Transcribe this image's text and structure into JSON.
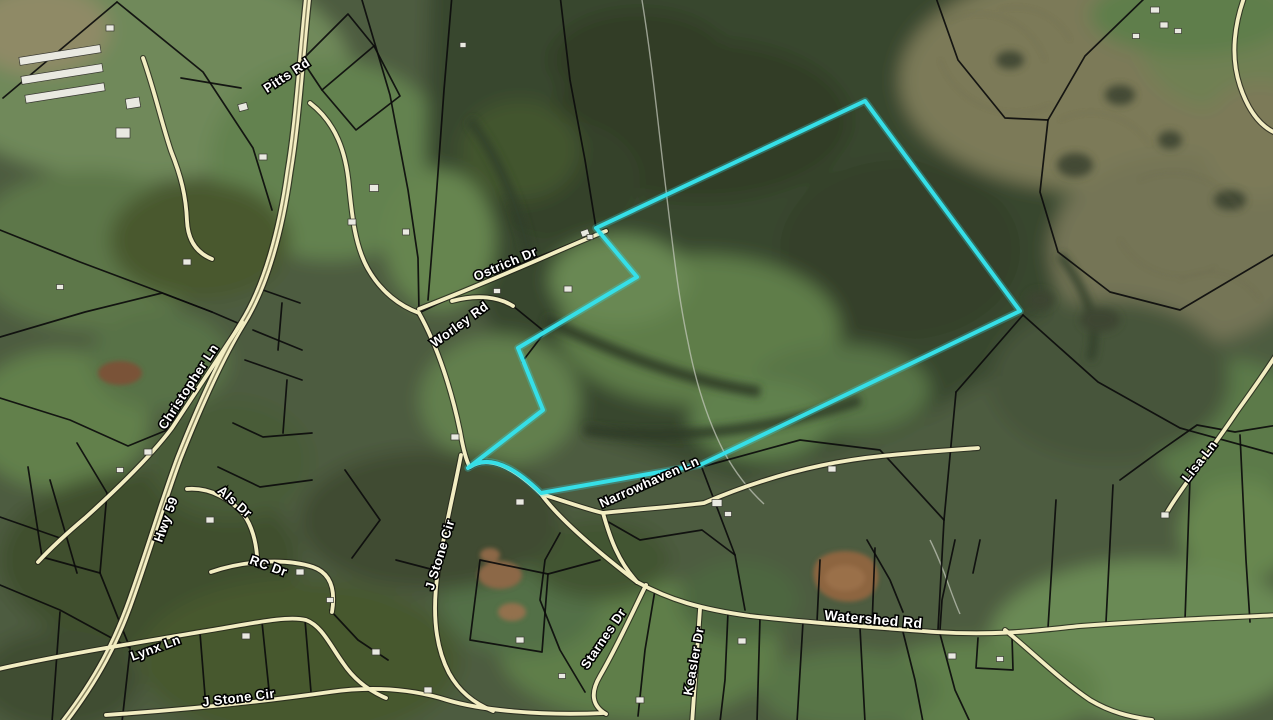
{
  "map": {
    "colors": {
      "highlight": "#36dfe8",
      "road_fill": "#f2edc2",
      "road_casing": "#23231a",
      "parcel_line": "#0c0c0c",
      "label_fill": "#ffffff",
      "label_outline": "#000000"
    },
    "highlight_parcel": {
      "path": "M596,228 L865,101 L1020,311 L700,465 L541,493 Q495,448 468,468 L543,410 L518,348 L637,277 Z"
    },
    "road_labels": [
      {
        "text": "Pitts Rd",
        "x": 289,
        "y": 79,
        "rot": -33,
        "size": 13
      },
      {
        "text": "Christopher Ln",
        "x": 192,
        "y": 389,
        "rot": -57,
        "size": 13
      },
      {
        "text": "Hwy 59",
        "x": 170,
        "y": 521,
        "rot": -70,
        "size": 13
      },
      {
        "text": "Als Dr",
        "x": 232,
        "y": 505,
        "rot": 41,
        "size": 13
      },
      {
        "text": "RC Dr",
        "x": 267,
        "y": 570,
        "rot": 20,
        "size": 13
      },
      {
        "text": "Lynx Ln",
        "x": 157,
        "y": 652,
        "rot": -20,
        "size": 13
      },
      {
        "text": "J Stone Cir",
        "x": 239,
        "y": 702,
        "rot": -7,
        "size": 13
      },
      {
        "text": "J Stone Cir",
        "x": 444,
        "y": 556,
        "rot": -73,
        "size": 13
      },
      {
        "text": "Ostrich Dr",
        "x": 507,
        "y": 268,
        "rot": -23,
        "size": 13
      },
      {
        "text": "Worley Rd",
        "x": 462,
        "y": 328,
        "rot": -36,
        "size": 13
      },
      {
        "text": "Starnes Dr",
        "x": 607,
        "y": 641,
        "rot": -56,
        "size": 13
      },
      {
        "text": "Keasler Dr",
        "x": 698,
        "y": 662,
        "rot": -80,
        "size": 13
      },
      {
        "text": "Narrowhaven Ln",
        "x": 651,
        "y": 486,
        "rot": -24,
        "size": 13
      },
      {
        "text": "Watershed Rd",
        "x": 873,
        "y": 624,
        "rot": 5,
        "size": 14
      },
      {
        "text": "Lisa Ln",
        "x": 1203,
        "y": 464,
        "rot": -52,
        "size": 13
      }
    ],
    "roads": [
      {
        "id": "pitts-hwy59",
        "name": "Pitts Rd / Hwy 59",
        "major": true,
        "path": "M308,-6 C301,58 298,118 289,172 C281,230 266,286 242,324 C220,360 198,410 179,458 C164,498 151,543 133,594 C117,641 97,679 64,722"
      },
      {
        "id": "christopher-ln",
        "name": "Christopher Ln",
        "major": false,
        "path": "M242,322 C222,352 203,381 172,428 C151,456 116,490 85,518 C66,534 50,549 38,562"
      },
      {
        "id": "als-dr",
        "name": "Als Dr",
        "major": false,
        "path": "M187,489 C210,487 232,500 244,515 C252,526 256,542 257,556"
      },
      {
        "id": "rc-dr",
        "name": "RC Dr",
        "major": false,
        "path": "M211,572 C240,562 282,557 313,567 C330,573 336,588 332,612"
      },
      {
        "id": "lynx-ln",
        "name": "Lynx Ln",
        "major": false,
        "path": "M-6,670 C60,655 130,644 200,632 C250,624 287,615 306,620 C322,626 330,645 343,663 C353,678 367,690 386,698"
      },
      {
        "id": "jstone-cir-s",
        "name": "J Stone Cir",
        "major": false,
        "path": "M106,715 C180,710 260,702 330,692 C372,686 412,689 447,700 C480,710 540,716 604,713"
      },
      {
        "id": "fork-n",
        "name": "",
        "major": false,
        "path": "M310,103 C336,123 346,152 349,186 C352,216 355,246 368,269 C381,292 400,306 419,313"
      },
      {
        "id": "fork-s",
        "name": "",
        "major": false,
        "path": "M419,313 C438,347 452,392 460,431 C463,448 466,461 470,467"
      },
      {
        "id": "jstone-cir-v",
        "name": "J Stone Cir",
        "major": false,
        "path": "M461,455 C454,492 444,532 438,571 C432,611 435,646 449,673 C459,691 473,703 493,711"
      },
      {
        "id": "ostrich-dr",
        "name": "Ostrich Dr",
        "major": false,
        "path": "M419,309 C460,293 510,272 556,252 C577,243 593,236 606,231"
      },
      {
        "id": "worley-rd",
        "name": "Worley Rd",
        "major": false,
        "path": "M452,301 C478,294 499,297 513,306"
      },
      {
        "id": "narrowhaven-w",
        "name": "Narrowhaven Ln",
        "major": false,
        "path": "M470,467 Q496,450 541,494 C562,500 582,508 603,513"
      },
      {
        "id": "narrowhaven-ne",
        "name": "Narrowhaven Ln",
        "major": false,
        "path": "M603,513 C640,509 672,507 704,503 C762,478 822,462 882,456 C920,452 950,450 978,448"
      },
      {
        "id": "jct-connector",
        "name": "",
        "major": false,
        "path": "M603,513 C610,538 618,561 637,582"
      },
      {
        "id": "lower-through",
        "name": "",
        "major": false,
        "path": "M541,494 C560,520 598,552 637,582"
      },
      {
        "id": "watershed-rd",
        "name": "Watershed Rd",
        "major": false,
        "path": "M637,582 C670,600 700,609 750,616 C810,623 872,627 935,632 C1000,636 1040,630 1080,626 C1160,620 1220,618 1278,615"
      },
      {
        "id": "keasler-dr",
        "name": "Keasler Dr",
        "major": false,
        "path": "M700,609 C698,640 695,680 692,724"
      },
      {
        "id": "starnes-dr",
        "name": "Starnes Dr",
        "major": false,
        "path": "M646,585 C636,605 618,645 600,676 C590,693 592,706 606,714"
      },
      {
        "id": "watershed-branch",
        "name": "",
        "major": false,
        "path": "M1005,630 C1030,650 1060,680 1090,700 C1110,712 1130,717 1152,720"
      },
      {
        "id": "lisa-ln",
        "name": "Lisa Ln",
        "major": false,
        "path": "M1278,352 C1260,380 1248,396 1236,413 C1220,437 1204,458 1190,478 C1180,492 1172,503 1166,514"
      },
      {
        "id": "farm-drive",
        "name": "",
        "major": false,
        "path": "M143,58 C155,92 161,121 171,151 C181,176 186,196 187,221 C188,241 197,253 212,259"
      },
      {
        "id": "oval-track",
        "name": "",
        "major": false,
        "path": "M1247,-10 C1234,22 1230,56 1240,86 C1249,113 1262,128 1278,134"
      }
    ],
    "parcel_lines": [
      "M117,2 L3,98",
      "M117,2 L203,72 L253,148 L272,210",
      "M181,78 L241,88",
      "M0,230 L80,262 L160,292 L212,312 L240,324",
      "M0,337 L85,312 L162,293 L212,312",
      "M0,398 L70,420 L128,446 L172,428",
      "M28,467 L42,557",
      "M0,517 L60,538 L85,518",
      "M77,443 L107,493 L100,573",
      "M50,480 L77,573",
      "M42,557 L100,573",
      "M0,585 L60,610 L130,648",
      "M100,573 L130,648",
      "M60,612 L52,722",
      "M130,650 L122,722",
      "M200,633 L206,708",
      "M262,622 L270,700",
      "M305,620 L311,692",
      "M263,290 L300,303",
      "M253,330 L302,350",
      "M245,360 L302,380",
      "M233,423 L263,437 L312,433",
      "M218,467 L260,487 L312,480",
      "M282,303 L278,350",
      "M287,380 L283,433",
      "M362,0 L390,95 L408,190 L418,258 L419,313",
      "M302,60 L348,14 L374,46 L322,90 L302,60",
      "M374,46 L400,96 L356,130 L322,90",
      "M419,313 L520,264 L606,230",
      "M513,306 L545,332 L522,362",
      "M452,-5 L444,90 L436,200 L428,300",
      "M560,-5 L570,80 L585,160 L596,228",
      "M1023,315 L1098,382 L1180,428 L1278,455",
      "M956,392 L1023,315",
      "M956,392 L944,520 L938,630",
      "M705,466 L800,440 L880,450 L944,520",
      "M702,468 L735,555 L745,610",
      "M605,520 L640,540 L702,530 L735,555",
      "M820,560 L817,622",
      "M875,548 L872,626",
      "M867,540 L890,580 L903,612",
      "M955,540 L942,600 L940,630",
      "M980,540 L973,573",
      "M480,560 L548,574 L542,652 L470,640 L480,560",
      "M548,574 L600,560",
      "M655,590 L645,650 L638,716",
      "M728,612 L725,680 L720,722",
      "M760,618 L757,722",
      "M803,622 L797,722",
      "M860,628 L865,722",
      "M903,632 L915,680 L923,722",
      "M940,634 L955,690 L970,722",
      "M978,638 L976,668 L1013,670 L1012,636",
      "M1056,500 L1048,628",
      "M1113,485 L1106,622",
      "M1190,478 L1185,620",
      "M1120,480 L1157,453 L1197,425 L1235,432 L1278,425",
      "M1148,-5 L1085,56 L1048,120 L1040,192 L1058,252 L1110,292 L1180,310 L1278,252",
      "M935,-5 L958,60 L1005,118 L1048,120",
      "M345,470 L380,520 L352,558",
      "M330,610 L358,640 L388,660",
      "M396,560 L438,571",
      "M560,533 L545,560 L540,600 L560,650 L585,692",
      "M1240,435 L1246,560 L1250,622"
    ],
    "tracks": [
      "M641,-6 C652,60 658,125 666,190 C673,248 678,295 688,342 C696,384 708,421 724,452 C736,474 750,491 764,504",
      "M930,540 C945,570 950,592 960,614"
    ],
    "structures": [
      [
        60,
        55,
        82,
        8,
        -9
      ],
      [
        62,
        74,
        82,
        8,
        -9
      ],
      [
        65,
        93,
        80,
        8,
        -9
      ],
      [
        133,
        103,
        14,
        10,
        -9
      ],
      [
        123,
        133,
        14,
        10,
        0
      ],
      [
        110,
        28,
        8,
        6,
        0
      ],
      [
        243,
        107,
        9,
        7,
        -15
      ],
      [
        263,
        157,
        8,
        6,
        0
      ],
      [
        187,
        262,
        8,
        6,
        0
      ],
      [
        60,
        287,
        7,
        5,
        0
      ],
      [
        374,
        188,
        9,
        7,
        0
      ],
      [
        352,
        222,
        8,
        6,
        0
      ],
      [
        406,
        232,
        7,
        6,
        0
      ],
      [
        585,
        233,
        8,
        6,
        -20
      ],
      [
        568,
        289,
        8,
        6,
        0
      ],
      [
        497,
        291,
        7,
        5,
        0
      ],
      [
        455,
        437,
        8,
        6,
        0
      ],
      [
        520,
        502,
        8,
        6,
        0
      ],
      [
        717,
        503,
        10,
        7,
        0
      ],
      [
        728,
        514,
        7,
        5,
        0
      ],
      [
        832,
        469,
        8,
        6,
        0
      ],
      [
        1155,
        10,
        9,
        6,
        0
      ],
      [
        1164,
        25,
        8,
        6,
        0
      ],
      [
        1178,
        31,
        7,
        5,
        0
      ],
      [
        1136,
        36,
        7,
        5,
        0
      ],
      [
        148,
        452,
        8,
        6,
        0
      ],
      [
        120,
        470,
        7,
        5,
        0
      ],
      [
        210,
        520,
        8,
        6,
        0
      ],
      [
        300,
        572,
        8,
        6,
        0
      ],
      [
        246,
        636,
        8,
        6,
        0
      ],
      [
        330,
        600,
        7,
        5,
        0
      ],
      [
        376,
        652,
        8,
        6,
        0
      ],
      [
        428,
        690,
        8,
        6,
        0
      ],
      [
        520,
        640,
        8,
        6,
        0
      ],
      [
        562,
        676,
        7,
        5,
        0
      ],
      [
        640,
        700,
        8,
        6,
        0
      ],
      [
        742,
        641,
        8,
        6,
        0
      ],
      [
        952,
        656,
        8,
        6,
        0
      ],
      [
        1000,
        659,
        7,
        5,
        0
      ],
      [
        1165,
        515,
        8,
        6,
        0
      ],
      [
        463,
        45,
        6,
        5,
        0
      ],
      [
        590,
        237,
        6,
        5,
        0
      ]
    ]
  }
}
